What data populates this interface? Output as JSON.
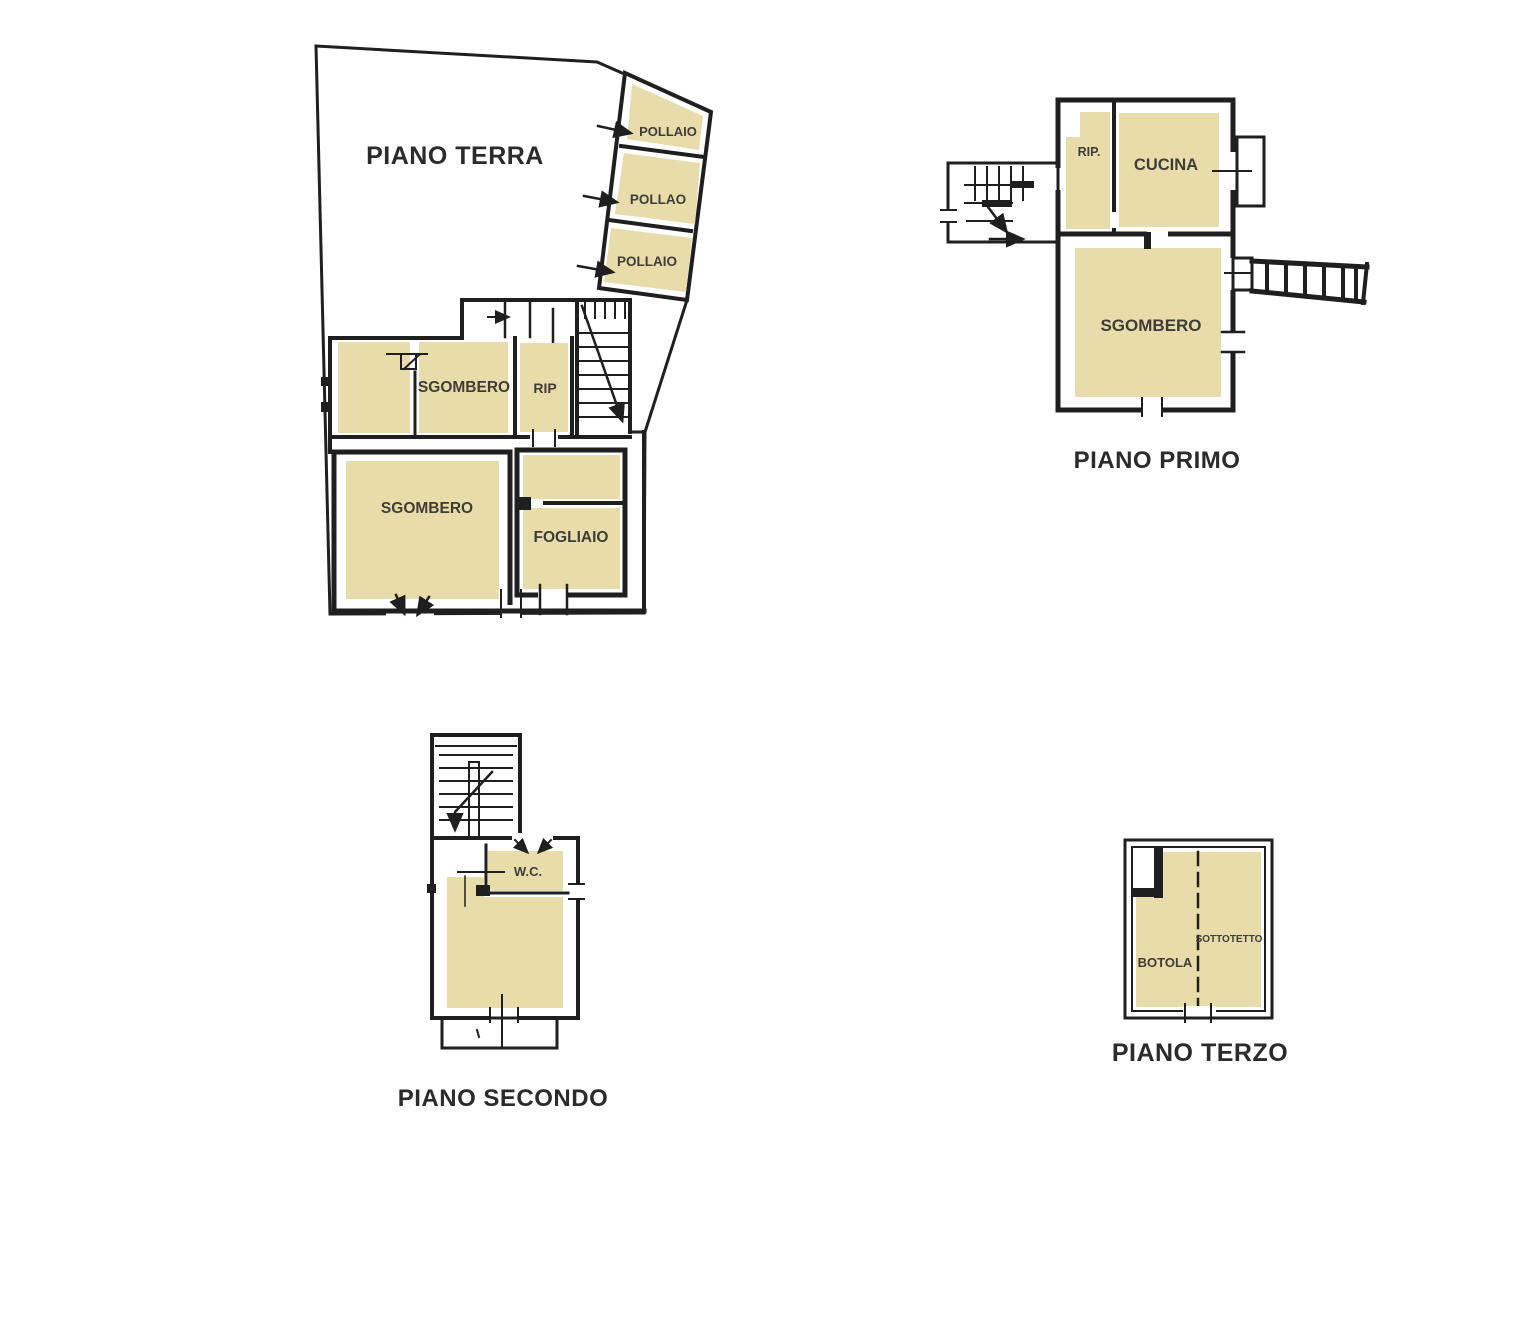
{
  "colors": {
    "room_fill": "#e9dcab",
    "wall": "#1f1f1f",
    "label": "#3f3d36",
    "title": "#2b2b2b",
    "paper": "#ffffff"
  },
  "floors": {
    "piano_terra": {
      "title": "PIANO TERRA",
      "rooms": {
        "pollaio_top": "POLLAIO",
        "pollao_mid": "POLLAO",
        "pollaio_bottom": "POLLAIO",
        "sgombero_upper": "SGOMBERO",
        "rip": "RIP",
        "sgombero_lower": "SGOMBERO",
        "fogliaio": "FOGLIAIO"
      }
    },
    "piano_primo": {
      "title": "PIANO PRIMO",
      "rooms": {
        "rip": "RIP.",
        "cucina": "CUCINA",
        "sgombero": "SGOMBERO"
      }
    },
    "piano_secondo": {
      "title": "PIANO SECONDO",
      "rooms": {
        "wc": "W.C."
      }
    },
    "piano_terzo": {
      "title": "PIANO TERZO",
      "rooms": {
        "botola": "BOTOLA",
        "sottotetto": "SOTTOTETTO"
      }
    }
  }
}
